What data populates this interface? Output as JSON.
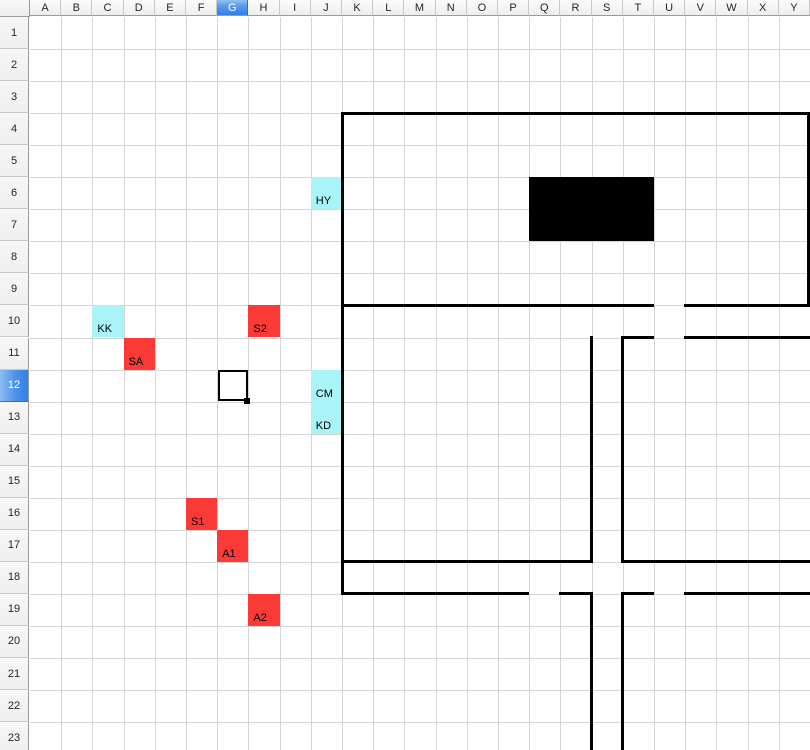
{
  "columns": [
    "A",
    "B",
    "C",
    "D",
    "E",
    "F",
    "G",
    "H",
    "I",
    "J",
    "K",
    "L",
    "M",
    "N",
    "O",
    "P",
    "Q",
    "R",
    "S",
    "T",
    "U",
    "V",
    "W",
    "X",
    "Y"
  ],
  "rows": [
    "1",
    "2",
    "3",
    "4",
    "5",
    "6",
    "7",
    "8",
    "9",
    "10",
    "11",
    "12",
    "13",
    "14",
    "15",
    "16",
    "17",
    "18",
    "19",
    "20",
    "21",
    "22",
    "23"
  ],
  "selection": {
    "active_cell": "G12",
    "selected_column": "G",
    "selected_row": "12"
  },
  "cells": [
    {
      "ref": "J6",
      "col": "J",
      "row": 6,
      "label": "HY",
      "fill": "cyan"
    },
    {
      "ref": "C10",
      "col": "C",
      "row": 10,
      "label": "KK",
      "fill": "cyan"
    },
    {
      "ref": "H10",
      "col": "H",
      "row": 10,
      "label": "S2",
      "fill": "red"
    },
    {
      "ref": "D11",
      "col": "D",
      "row": 11,
      "label": "SA",
      "fill": "red"
    },
    {
      "ref": "J12",
      "col": "J",
      "row": 12,
      "label": "CM",
      "fill": "cyan"
    },
    {
      "ref": "J13",
      "col": "J",
      "row": 13,
      "label": "KD",
      "fill": "cyan"
    },
    {
      "ref": "F16",
      "col": "F",
      "row": 16,
      "label": "S1",
      "fill": "red"
    },
    {
      "ref": "G17",
      "col": "G",
      "row": 17,
      "label": "A1",
      "fill": "red"
    },
    {
      "ref": "H19",
      "col": "H",
      "row": 19,
      "label": "A2",
      "fill": "red"
    }
  ],
  "filled_region": {
    "from_col": "Q",
    "from_row": 6,
    "to_col": "T",
    "to_row": 7,
    "color": "#000000"
  },
  "borders": {
    "thickness": 3,
    "horizontal": [
      {
        "row": 4,
        "from": "K",
        "to_end": true
      },
      {
        "row": 10,
        "from": "K",
        "to": "U"
      },
      {
        "row": 10,
        "from": "V",
        "to_end": true
      },
      {
        "row": 11,
        "from": "T",
        "to": "U"
      },
      {
        "row": 11,
        "from": "V",
        "to_end": true
      },
      {
        "row": 18,
        "from": "K",
        "to": "S"
      },
      {
        "row": 18,
        "from": "T",
        "to_end": true
      },
      {
        "row": 19,
        "from": "K",
        "to": "Q"
      },
      {
        "row": 19,
        "from": "R",
        "to": "S"
      },
      {
        "row": 19,
        "from": "T",
        "to": "U"
      },
      {
        "row": 19,
        "from": "V",
        "to_end": true
      }
    ],
    "vertical": [
      {
        "col": "K",
        "from_row": 4,
        "to_row": 19
      },
      {
        "right_edge": true,
        "from_row": 4,
        "to_row": 10
      },
      {
        "col": "S",
        "from_row": 11,
        "to_row": 18
      },
      {
        "col": "T",
        "from_row": 11,
        "to_row": 18
      },
      {
        "col": "S",
        "from_row": 19,
        "to_bottom": true
      },
      {
        "col": "T",
        "from_row": 19,
        "to_bottom": true
      }
    ]
  },
  "colors": {
    "cyan": "#a9f4f8",
    "red": "#fb3937",
    "gridline": "#d5d5d5",
    "border_black": "#000000",
    "header_selected_blue": "#3181e8"
  }
}
